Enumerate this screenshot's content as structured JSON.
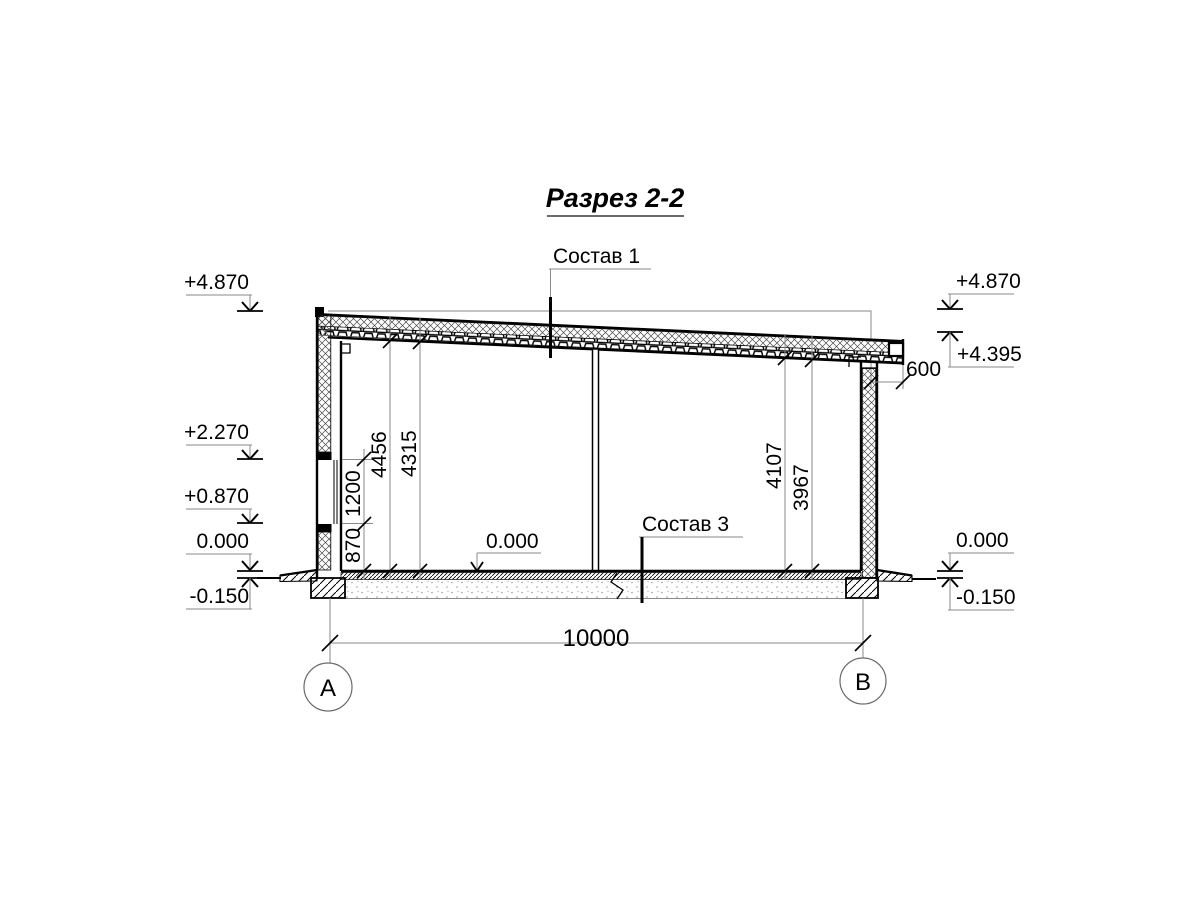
{
  "title": "Разрез 2-2",
  "callouts": {
    "roof": "Состав 1",
    "floor": "Состав 3",
    "level_floor": "0.000"
  },
  "elevations": {
    "left": [
      "+4.870",
      "+2.270",
      "+0.870",
      "0.000",
      "-0.150"
    ],
    "right": [
      "+4.870",
      "+4.395",
      "0.000",
      "-0.150"
    ]
  },
  "dims": {
    "sill": "870",
    "window": "1200",
    "h_left_outer": "4456",
    "h_left_inner": "4315",
    "h_right_outer": "4107",
    "h_right_inner": "3967",
    "overhang": "600",
    "span": "10000"
  },
  "axes": {
    "a": "А",
    "b": "В"
  },
  "colors": {
    "line": "#000000",
    "thin_line": "#8a8a8a",
    "background": "#ffffff"
  }
}
